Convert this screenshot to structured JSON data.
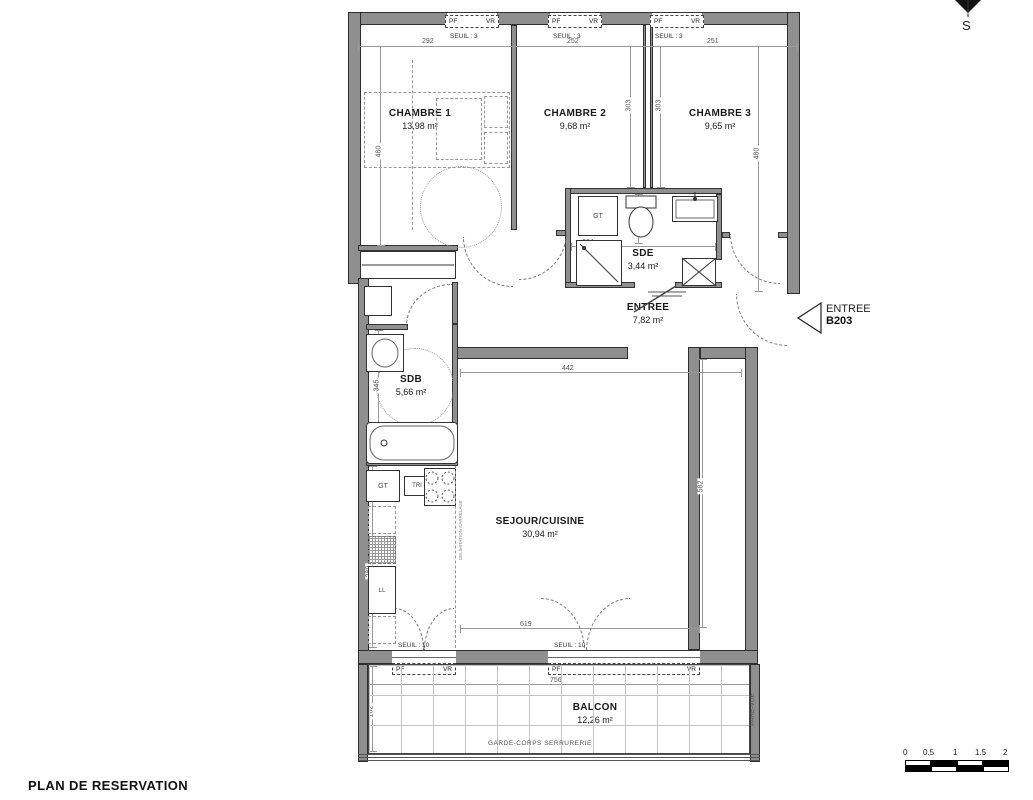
{
  "title": "PLAN DE RESERVATION",
  "compass": {
    "south_label": "S"
  },
  "entry_marker": {
    "line1": "ENTREE",
    "line2": "B203"
  },
  "rooms": {
    "chambre1": {
      "name": "CHAMBRE 1",
      "area": "13,98 m²"
    },
    "chambre2": {
      "name": "CHAMBRE 2",
      "area": "9,68 m²"
    },
    "chambre3": {
      "name": "CHAMBRE 3",
      "area": "9,65 m²"
    },
    "sde": {
      "name": "SDE",
      "area": "3,44 m²"
    },
    "entree": {
      "name": "ENTREE",
      "area": "7,82 m²"
    },
    "sdb": {
      "name": "SDB",
      "area": "5,66 m²"
    },
    "sejour": {
      "name": "SEJOUR/CUISINE",
      "area": "30,94 m²"
    },
    "balcon": {
      "name": "BALCON",
      "area": "12,26 m²"
    }
  },
  "dims": {
    "top1": "292",
    "top2": "252",
    "top3": "251",
    "left_v": "480",
    "mid_v1": "303",
    "mid_v2": "303",
    "right_v": "480",
    "sde_w": "264",
    "sde_h": "170",
    "hall_w": "442",
    "sejour_v": "582",
    "sdb_v": "345",
    "bath_w": "170",
    "kitchen_v": "289",
    "sejour_w": "619",
    "balcon_w": "756",
    "balcon_v": "162"
  },
  "annotations": {
    "seuil3": "SEUIL : 3",
    "seuil10": "SEUIL : 10",
    "pf": "PF",
    "vr": "VR",
    "gt": "GT",
    "tri": "TRI",
    "ll": "LL",
    "garde_corps": "GARDE-CORPS SERRURERIE",
    "pare_vue": "PARE-VUE",
    "carrelage": "DELIMITATION CARRELAGE"
  },
  "scale_bar": {
    "ticks": [
      "0",
      "0.5",
      "1",
      "1.5",
      "2"
    ]
  },
  "colors": {
    "wall": "#8f8f8f",
    "line": "#2f2f2f",
    "dim": "#555555"
  }
}
